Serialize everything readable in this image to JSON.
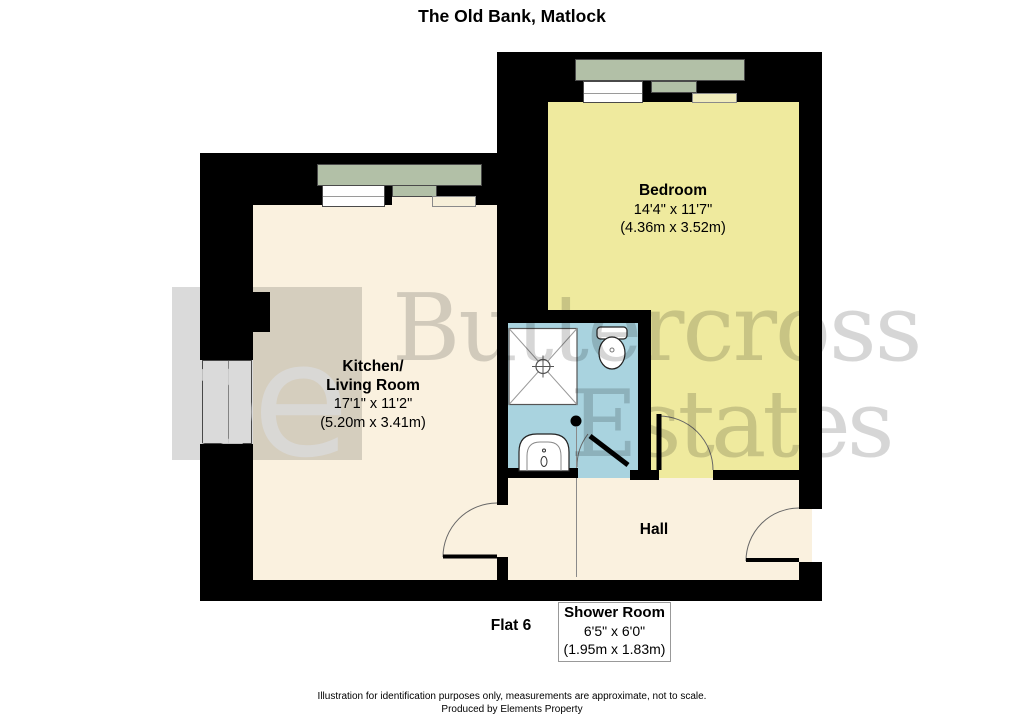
{
  "title": "The Old Bank, Matlock",
  "flat_label": "Flat 6",
  "rooms": {
    "bedroom": {
      "name": "Bedroom",
      "dims_imperial": "14'4\" x 11'7\"",
      "dims_metric": "(4.36m x 3.52m)"
    },
    "kitchen_living": {
      "name_line1": "Kitchen/",
      "name_line2": "Living Room",
      "dims_imperial": "17'1\" x 11'2\"",
      "dims_metric": "(5.20m x 3.41m)"
    },
    "hall": {
      "name": "Hall"
    },
    "shower_room": {
      "name": "Shower Room",
      "dims_imperial": "6'5\" x 6'0\"",
      "dims_metric": "(1.95m x 1.83m)"
    }
  },
  "watermark": {
    "logo_text": "be",
    "wordmark_line1": "Buttercross",
    "wordmark_line2": "Estates"
  },
  "footer": {
    "disclaimer": "Illustration for identification purposes only, measurements are approximate, not to scale.",
    "credit": "Produced by Elements Property"
  },
  "colors": {
    "wall": "#000000",
    "kitchen_floor": "#FAF1DF",
    "hall_floor": "#FAF1DF",
    "bedroom_floor": "#EFEA9E",
    "shower_floor": "#A9D3DF",
    "bay_window": "#B2C0A7",
    "watermark_gray": "#DADADA",
    "page_bg": "#FFFFFF"
  }
}
